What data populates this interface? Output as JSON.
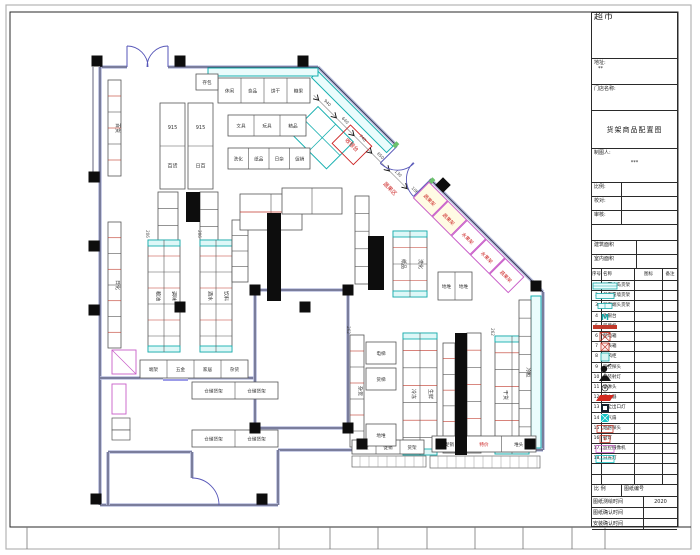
{
  "title_block": {
    "store_type": "超市",
    "address_label": "地址:",
    "address_value": "**",
    "store_name_label": "门店名称:",
    "drawing_title": "货架商品配置图",
    "drafter_label": "制图人:",
    "drafter_value": "***",
    "scale_label": "比例:",
    "check_label": "校对:",
    "review_label": "审核:",
    "building_area_label": "建筑面积",
    "indoor_area_label": "室内面积",
    "legend_headers": [
      "序号",
      "名称",
      "图标",
      "备注"
    ],
    "legend_rows": [
      {
        "no": "1",
        "name": "双面中岛货架",
        "icon": "shelf-double",
        "note": ""
      },
      {
        "no": "2",
        "name": "单面靠墙货架",
        "icon": "shelf-single",
        "note": ""
      },
      {
        "no": "3",
        "name": "双面端头货架",
        "icon": "shelf-end",
        "note": ""
      },
      {
        "no": "4",
        "name": "收银台",
        "icon": "cashier",
        "note": ""
      },
      {
        "no": "5",
        "name": "风幕机",
        "icon": "air-curtain",
        "note": ""
      },
      {
        "no": "6",
        "name": "配电箱",
        "icon": "power-box",
        "note": ""
      },
      {
        "no": "7",
        "name": "电表箱",
        "icon": "meter-box",
        "note": ""
      },
      {
        "no": "8",
        "name": "冷风柜",
        "icon": "cooler",
        "note": ""
      },
      {
        "no": "9",
        "name": "监控探头",
        "icon": "camera-dome",
        "note": ""
      },
      {
        "no": "10",
        "name": "吊装射灯",
        "icon": "lamp",
        "note": ""
      },
      {
        "no": "11",
        "name": "喷淋头",
        "icon": "sprinkler",
        "note": ""
      },
      {
        "no": "12",
        "name": "灭火器",
        "icon": "extinguisher",
        "note": ""
      },
      {
        "no": "13",
        "name": "安全出口灯",
        "icon": "exit-light",
        "note": ""
      },
      {
        "no": "14",
        "name": "排气扇",
        "icon": "fan",
        "note": ""
      },
      {
        "no": "15",
        "name": "烟感探头",
        "icon": "smoke",
        "note": ""
      },
      {
        "no": "16",
        "name": "射灯",
        "icon": "spot",
        "note": ""
      },
      {
        "no": "17",
        "name": "监控摄像机",
        "icon": "camera",
        "note": ""
      },
      {
        "no": "18",
        "name": "日光灯",
        "icon": "tube-light",
        "note": ""
      },
      {
        "no": "",
        "name": "",
        "icon": "none",
        "note": ""
      },
      {
        "no": "",
        "name": "",
        "icon": "none",
        "note": ""
      }
    ],
    "footer": {
      "scale_label": "比 例",
      "sheet_no_label": "图纸编号",
      "rows": [
        {
          "label": "图纸测绘时间",
          "value": "2020"
        },
        {
          "label": "图纸确认时间",
          "value": ""
        },
        {
          "label": "安装确认时间",
          "value": ""
        }
      ]
    }
  },
  "plan": {
    "cashier_label": "收银台",
    "produce_area_label": "蔬果区",
    "bag_storage_label": "存包",
    "gondola_915": [
      [
        "915",
        "百货"
      ],
      [
        "915",
        "日百"
      ]
    ],
    "wall_shelf_labels": [
      "百货",
      "日化"
    ],
    "gondola_pairs": [
      [
        "粮油",
        "调味"
      ],
      [
        "酒水",
        "饮料"
      ],
      [
        "冷冻",
        "生鲜"
      ],
      [
        "干货",
        "粮杂"
      ],
      [
        "纸品",
        "洗化"
      ]
    ],
    "single_labels": [
      "杂货",
      "冷柜"
    ],
    "top_row_labels": [
      "休闲",
      "食品",
      "饼干",
      "糖果"
    ],
    "mid_row1_labels": [
      "文具",
      "玩具",
      "精品"
    ],
    "mid_row2_labels": [
      "洗化",
      "纸品",
      "日杂",
      "促销"
    ],
    "endcap_row_labels": [
      "端架",
      "五金",
      "家居",
      "杂货"
    ],
    "warehouse_shelf_label": "仓储货架",
    "floor_stack_label": "地堆",
    "lift_labels": [
      "电梯",
      "货梯"
    ],
    "bottom_right_row_labels": [
      "促销",
      "特价",
      "堆头"
    ],
    "bottom_mid_row_labels": [
      "端架",
      "促销",
      "货架"
    ],
    "produce_shelf_labels": [
      "蔬果架",
      "蔬果架",
      "水果架",
      "水果架",
      "蔬果架"
    ],
    "diagonal_dims": [
      "940",
      "640",
      "740",
      "650",
      "130",
      "1060"
    ],
    "side_dims": [
      "206",
      "206",
      "262",
      "262"
    ]
  }
}
